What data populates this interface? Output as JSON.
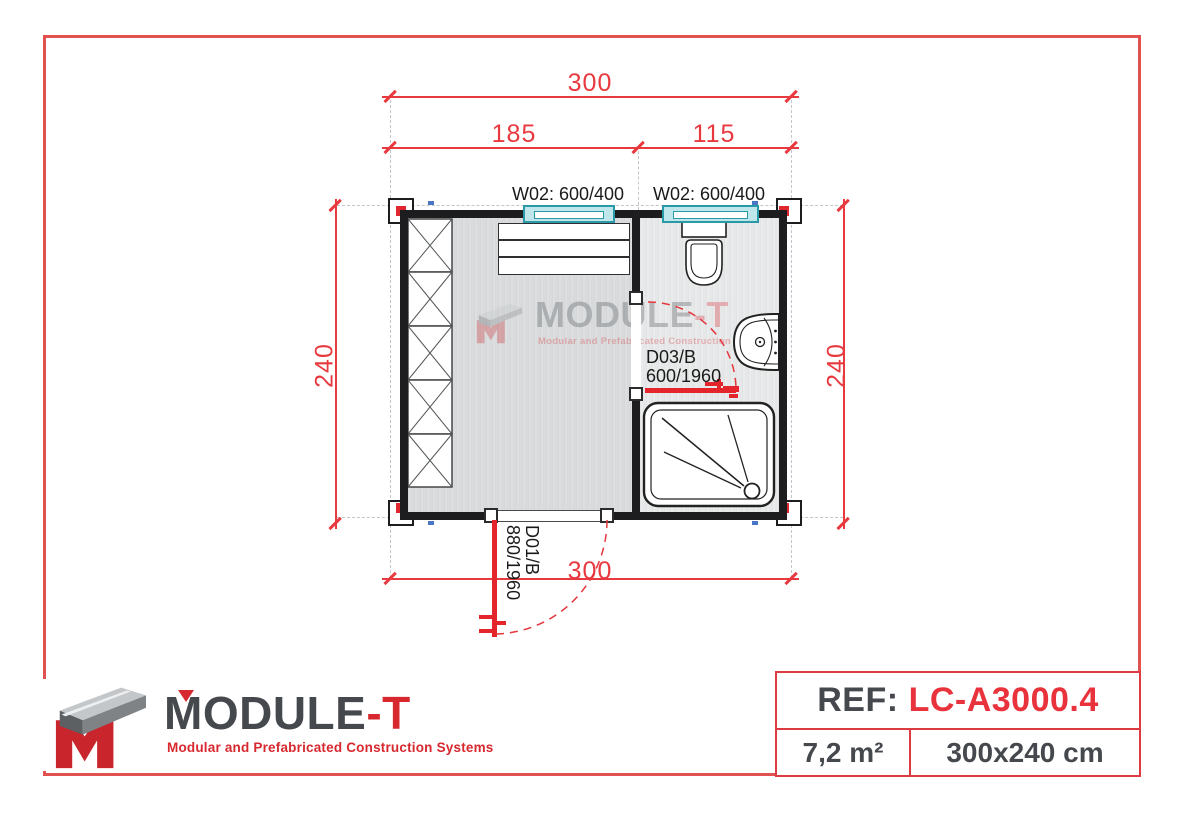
{
  "plan": {
    "dim_top_total": "300",
    "dim_top_left": "185",
    "dim_top_right": "115",
    "dim_left": "240",
    "dim_right": "240",
    "dim_bottom": "300",
    "window_left_label": "W02: 600/400",
    "window_right_label": "W02: 600/400",
    "door_bath_code": "D03/B",
    "door_bath_size": "600/1960",
    "door_entry_code": "D01/B",
    "door_entry_size": "880/1960"
  },
  "watermark": {
    "brand_main": "MODULE",
    "brand_suffix": "-T",
    "tagline": "Modular and Prefabricated Construction Systems"
  },
  "logo": {
    "brand_main": "MODULE",
    "brand_suffix": "-T",
    "tagline": "Modular and Prefabricated Construction Systems"
  },
  "ref_panel": {
    "ref_label": "REF:",
    "ref_value": "LC-A3000.4",
    "area": "7,2 m²",
    "dimensions": "300x240 cm"
  },
  "colors": {
    "frame_red": "#e0514f",
    "dimension_red": "#e8393f",
    "door_red": "#e4262c",
    "brand_red": "#d7282f",
    "ref_red": "#e8323c",
    "dark_text": "#45494d",
    "wall_black": "#1d1d1f",
    "window_cyan": "#bfe7eb"
  }
}
